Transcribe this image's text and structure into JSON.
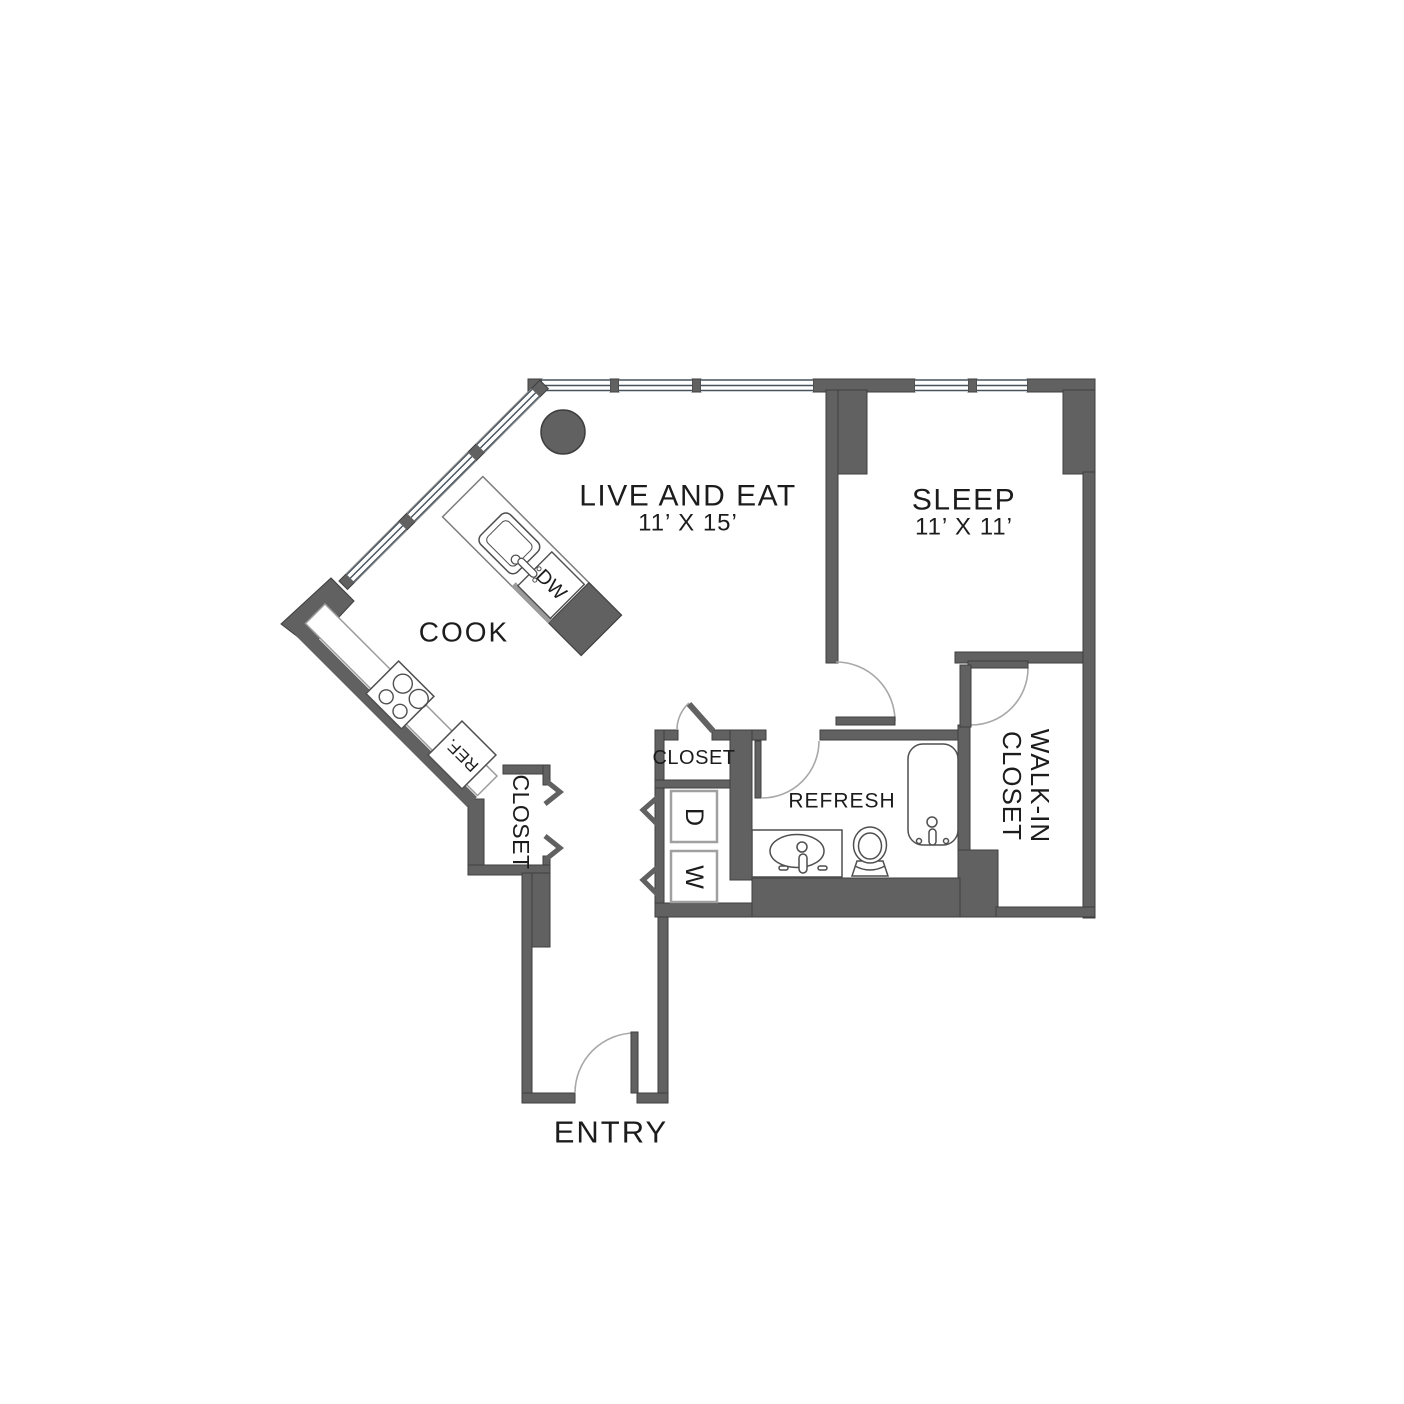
{
  "plan": {
    "title": "One-bedroom apartment floor plan",
    "rooms": {
      "live_and_eat": {
        "label": "LIVE AND EAT",
        "dims": "11’ X 15’"
      },
      "sleep": {
        "label": "SLEEP",
        "dims": "11’ X 11’"
      },
      "cook": {
        "label": "COOK"
      },
      "refresh": {
        "label": "REFRESH"
      },
      "entry": {
        "label": "ENTRY"
      },
      "hall_closet": {
        "label": "CLOSET"
      },
      "entry_closet": {
        "label": "CLOSET"
      },
      "walk_in_closet": {
        "line1": "WALK-IN",
        "line2": "CLOSET"
      }
    },
    "appliances": {
      "dishwasher": "DW",
      "refrigerator": "REF.",
      "dryer": "D",
      "washer": "W"
    },
    "colors": {
      "wall": "#616161",
      "wall_outline": "#3e3e3e",
      "window_line": "#47525c",
      "fixture_outline": "#4f4f4f",
      "light_outline": "#a0a0a0",
      "door_arc": "#a8a8a8",
      "table_circle": "#616161",
      "text": "#1c1c1c",
      "background": "#ffffff"
    }
  }
}
